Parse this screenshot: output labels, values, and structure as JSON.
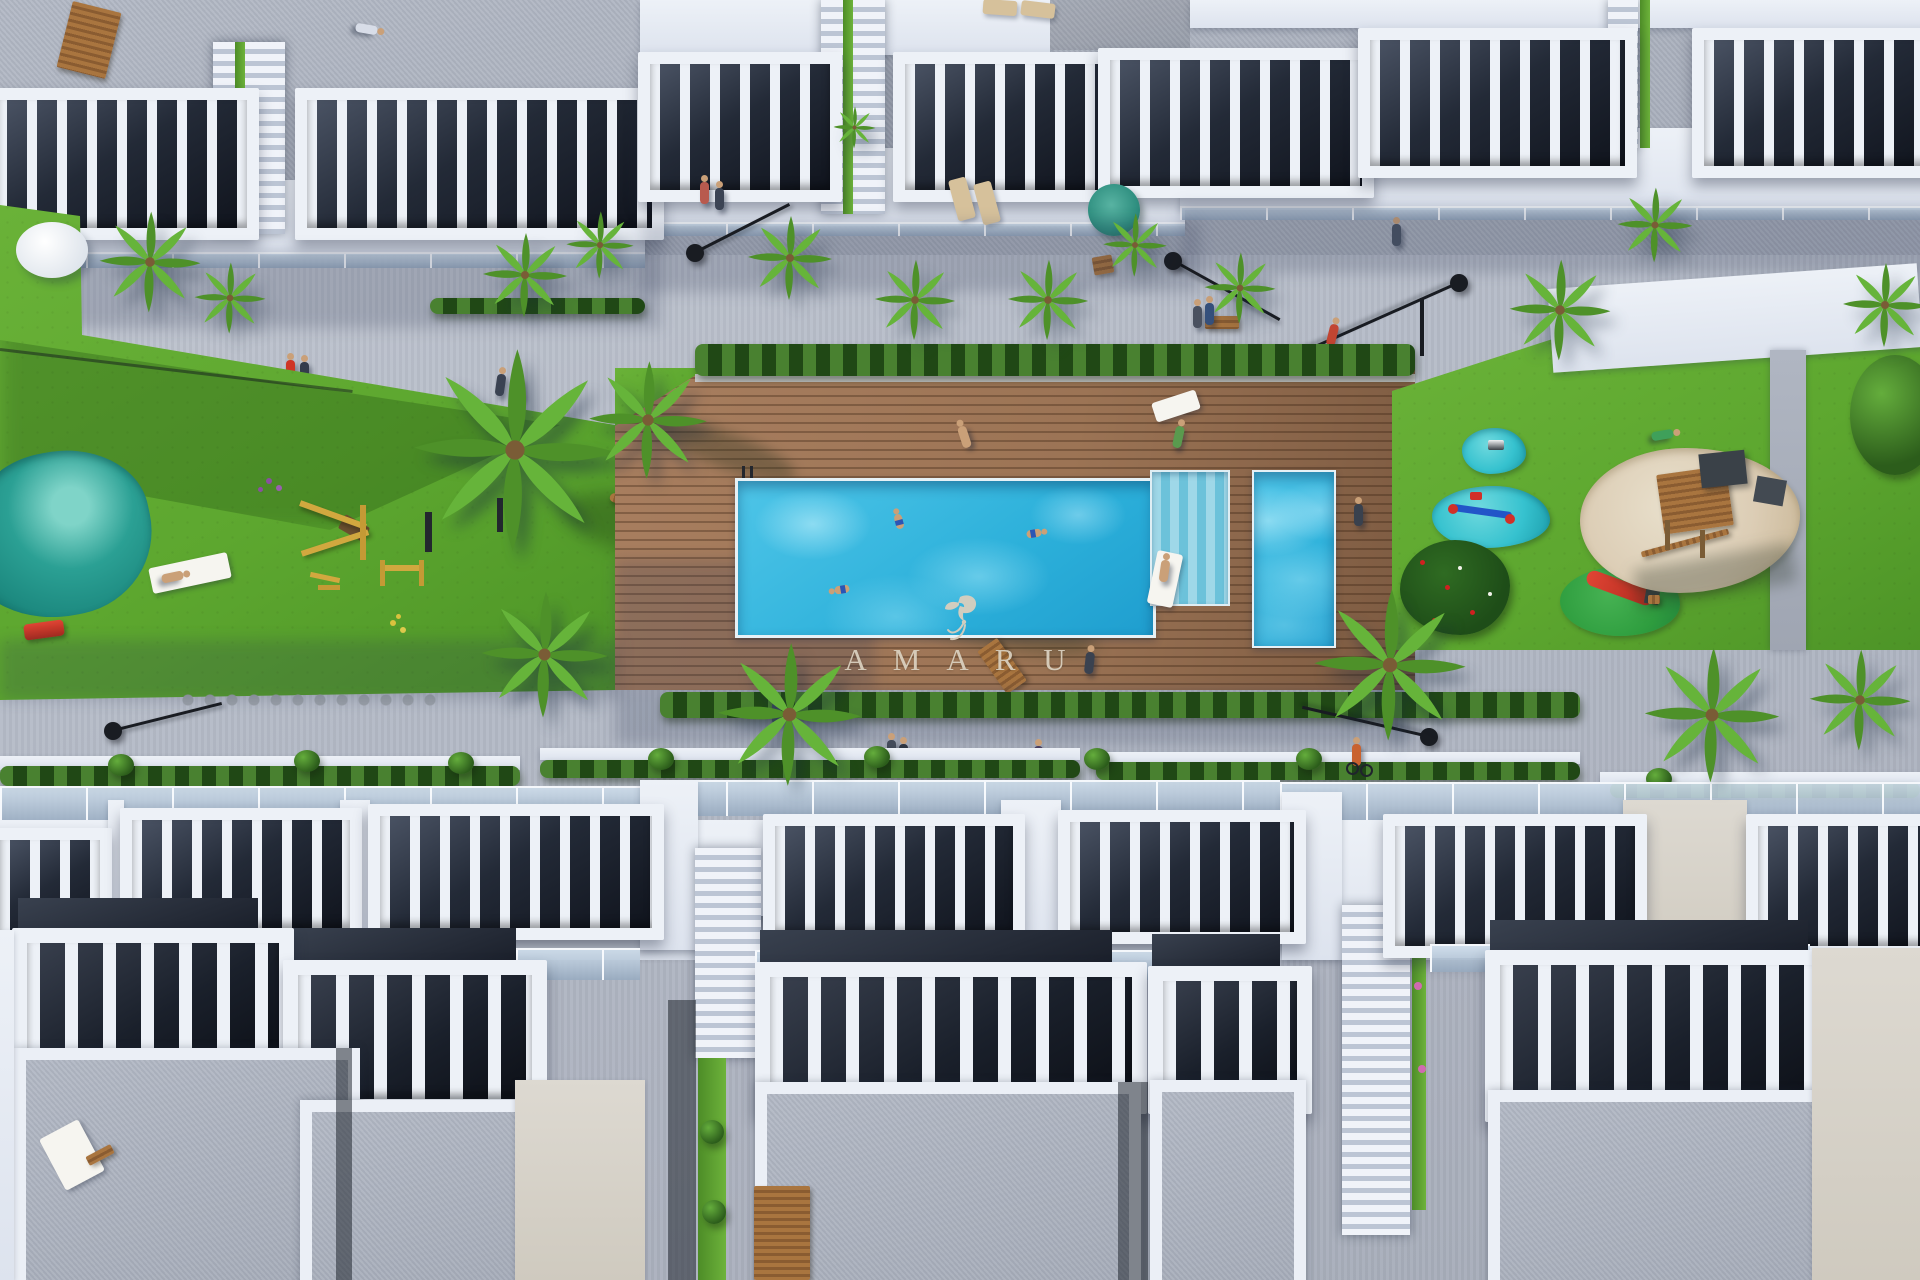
{
  "scene": {
    "type": "aerial-architectural-render",
    "subject": "Bird's-eye 3D rendering of a white residential complex with communal pool, wooden sun deck, lawns, outdoor gym and playground",
    "watermark": {
      "brand": "AMARU",
      "display_text": "A M A R U",
      "logo": "hummingbird-flourish"
    }
  },
  "palette": {
    "pavement": "#b6bcc8",
    "building_white": "#edf1f7",
    "roof_gray": "#a7adba",
    "dark_interior": "#1a1f2a",
    "grass": "#5da72f",
    "hedge": "#2e6120",
    "deck": "#9c7455",
    "pool": "#2cb0da",
    "pond": "#1d8a80",
    "playmat": "#36c2cf",
    "sand": "#dccdb5",
    "watermark": "#d9cfbe",
    "lamp": "#191c22",
    "skin": "#caa078"
  }
}
